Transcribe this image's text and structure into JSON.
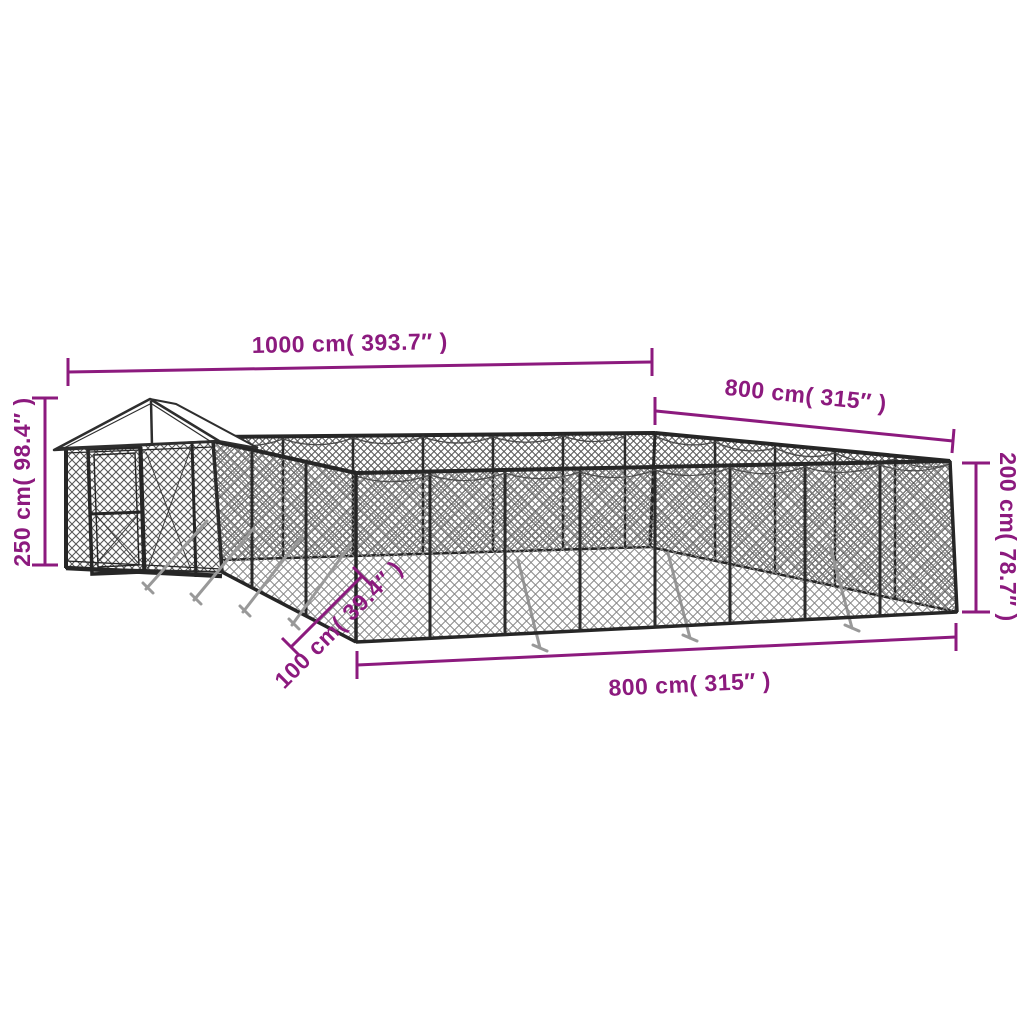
{
  "diagram": {
    "type": "product-dimension-diagram",
    "subject": "outdoor chain-link dog kennel with gable-roof entry",
    "background_color": "#ffffff",
    "dimension_color": "#8c1a7e",
    "frame_color": "#262626",
    "mesh_light_color": "#8a8a8a",
    "mesh_dark_color": "#5a5a5a",
    "roof_color": "#ffffff",
    "stake_color": "#999999",
    "dimensions": {
      "top_width": "1000 cm( 393.7″ )",
      "upper_right_depth": "800 cm( 315″ )",
      "left_height": "250 cm( 98.4″ )",
      "right_height": "200 cm( 78.7″ )",
      "bottom_front": "800 cm( 315″ )",
      "entry_offset": "100 cm( 39.4″ )"
    }
  }
}
